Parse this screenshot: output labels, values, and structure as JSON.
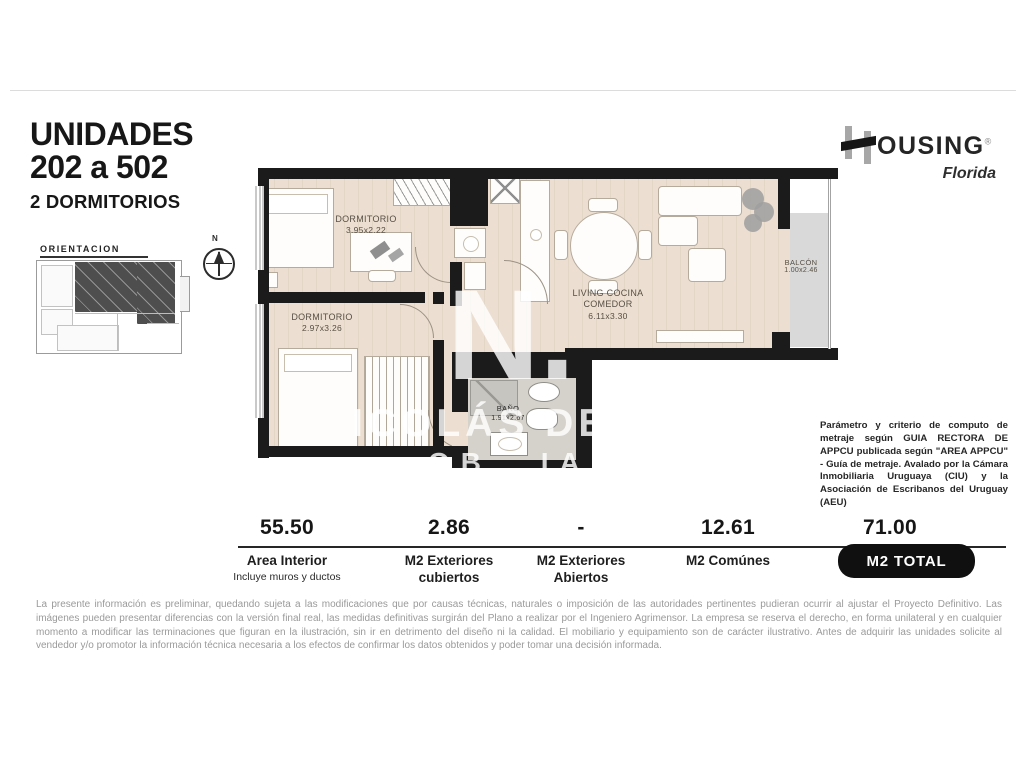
{
  "header": {
    "title_line1": "UNIDADES",
    "title_line2": "202 a 502",
    "subtitle": "2 DORMITORIOS"
  },
  "brand": {
    "name_rest": "OUSING",
    "registered": "®",
    "region": "Florida"
  },
  "orientation": {
    "label": "ORIENTACION",
    "street": "CALLE FLORIDA",
    "compass_north": "N"
  },
  "floorplan": {
    "rooms": [
      {
        "name": "DORMITORIO",
        "dims": "3.95x2.22"
      },
      {
        "name": "DORMITORIO",
        "dims": "2.97x3.26"
      },
      {
        "name": "LIVING COCINA COMEDOR",
        "dims": "6.11x3.30"
      },
      {
        "name": "BALCÓN",
        "dims": "1.00x2.46"
      },
      {
        "name": "BAÑO",
        "dims": "1.91x2.67"
      }
    ],
    "watermark": {
      "monogram": "N.",
      "line1": "ICOLÁS DE MO",
      "line2": "OB IAR"
    }
  },
  "metraje_note": "Parámetro y criterio de computo de metraje según GUIA RECTORA DE APPCU publicada según \"AREA APPCU\" - Guía de metraje. Avalado por la Cámara Inmobiliaria Uruguaya (CIU) y la Asociación de Escribanos del Uruguay (AEU)",
  "areas": {
    "columns": [
      {
        "value": "55.50",
        "label": "Area Interior",
        "label2": "",
        "note": "Incluye muros y ductos"
      },
      {
        "value": "2.86",
        "label": "M2 Exteriores",
        "label2": "cubiertos",
        "note": ""
      },
      {
        "value": "-",
        "label": "M2 Exteriores",
        "label2": "Abiertos",
        "note": ""
      },
      {
        "value": "12.61",
        "label": "M2 Comúnes",
        "label2": "",
        "note": ""
      },
      {
        "value": "71.00",
        "label": "M2 TOTAL",
        "label2": "",
        "note": ""
      }
    ]
  },
  "disclaimer": "La presente información es preliminar, quedando sujeta a las modificaciones que por causas técnicas, naturales o imposición de las autoridades pertinentes pudieran ocurrir al ajustar el Proyecto Definitivo. Las imágenes pueden presentar diferencias con la versión final real, las medidas definitivas surgirán del Plano a realizar por el Ingeniero Agrimensor. La empresa se reserva el derecho, en forma unilateral y en cualquier momento a modificar las terminaciones que figuran en la ilustración, sin ir en detrimento del diseño ni la calidad. El mobiliario y equipamiento son de carácter ilustrativo. Antes de adquirir las unidades solicite al vendedor y/o promotor la información técnica necesaria a los efectos de confirmar los datos obtenidos y poder tomar una decisión informada.",
  "colors": {
    "wall": "#1b1b1b",
    "floor": "#ecdfd1",
    "balcony_floor": "#d9d9d9",
    "badge": "#101010"
  }
}
